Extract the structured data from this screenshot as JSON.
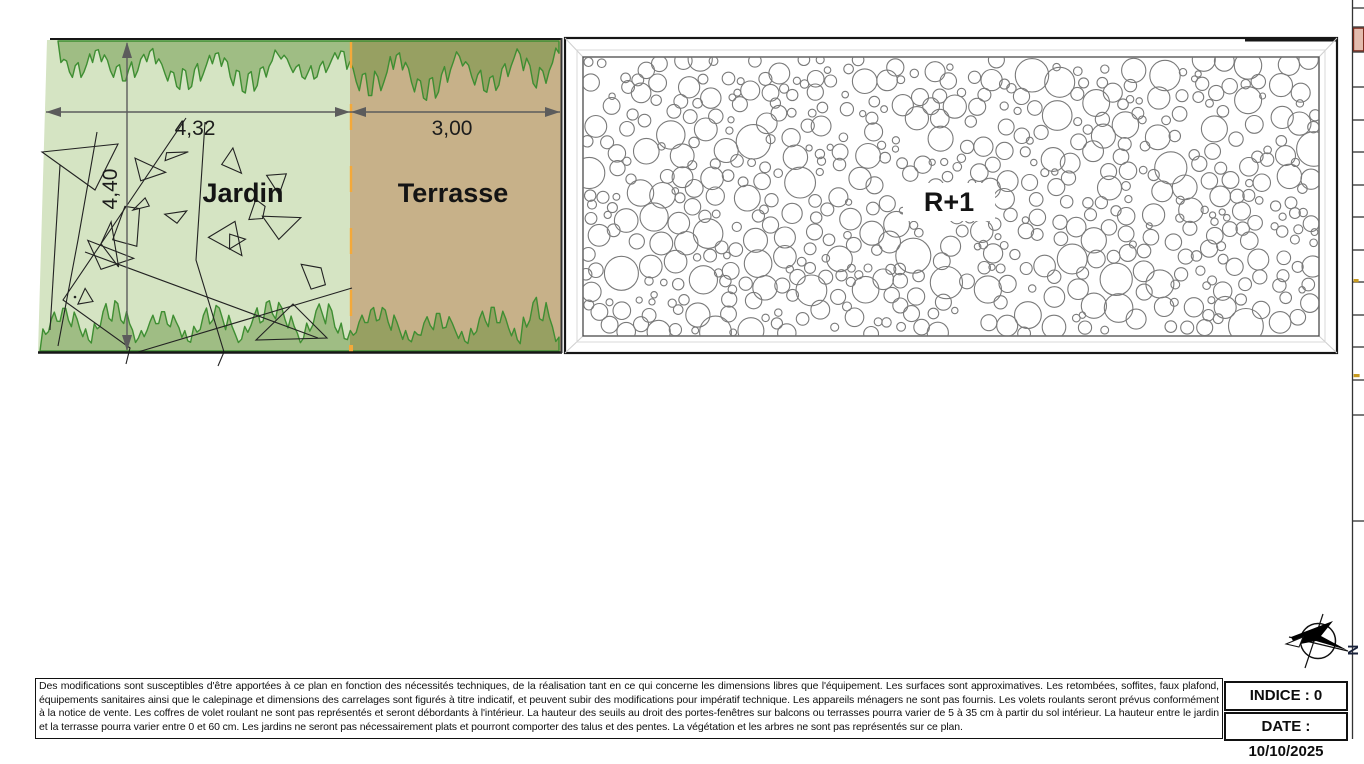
{
  "plan": {
    "jardin": {
      "label": "Jardin",
      "width_dim": "4,32",
      "depth_dim": "4,40"
    },
    "terrasse": {
      "label": "Terrasse",
      "width_dim": "3,00"
    },
    "building": {
      "label": "R+1"
    },
    "compass": {
      "north_label": "N"
    }
  },
  "footer": {
    "disclaimer": "Des modifications sont susceptibles d'être apportées à ce plan en fonction des nécessités techniques, de la réalisation tant en ce qui concerne les dimensions libres que l'équipement. Les surfaces sont approximatives. Les retombées, soffites, faux plafond, équipements sanitaires ainsi que le calepinage et dimensions des carrelages sont figurés à titre indicatif, et peuvent subir des modifications pour impératif technique. Les appareils ménagers ne sont pas fournis. Les volets roulants seront prévus conformément à la notice de vente. Les coffres de volet roulant ne sont pas représentés et seront débordants à l'intérieur. La hauteur des seuils au droit des portes-fenêtres sur balcons ou terrasses pourra varier de 5 à 35 cm à partir du sol intérieur. La hauteur entre le jardin et la terrasse pourra varier entre 0 et 60 cm. Les jardins ne seront pas nécessairement plats et pourront comporter des talus et des pentes. La végétation et les arbres ne sont pas représentés sur ce plan.",
    "revision": {
      "indice": "INDICE : 0",
      "date": "DATE : 10/10/2025"
    }
  },
  "colors": {
    "jardin_fill": "#d5e4c3",
    "terrasse_fill": "#c7b189",
    "hedge_overlay": "rgba(85,135,45,0.42)",
    "hedge_stroke": "#3e8e32",
    "scribble_stroke": "#222222",
    "dim_stroke": "#5c5c5c",
    "outline": "#161616",
    "circle_stroke": "#7a7a7a",
    "accent_orange": "#f4a93a",
    "strip_red_fill": "#e3bcae",
    "strip_red_stroke": "#7b2c1e",
    "strip_yellow": "#c79a1e"
  }
}
